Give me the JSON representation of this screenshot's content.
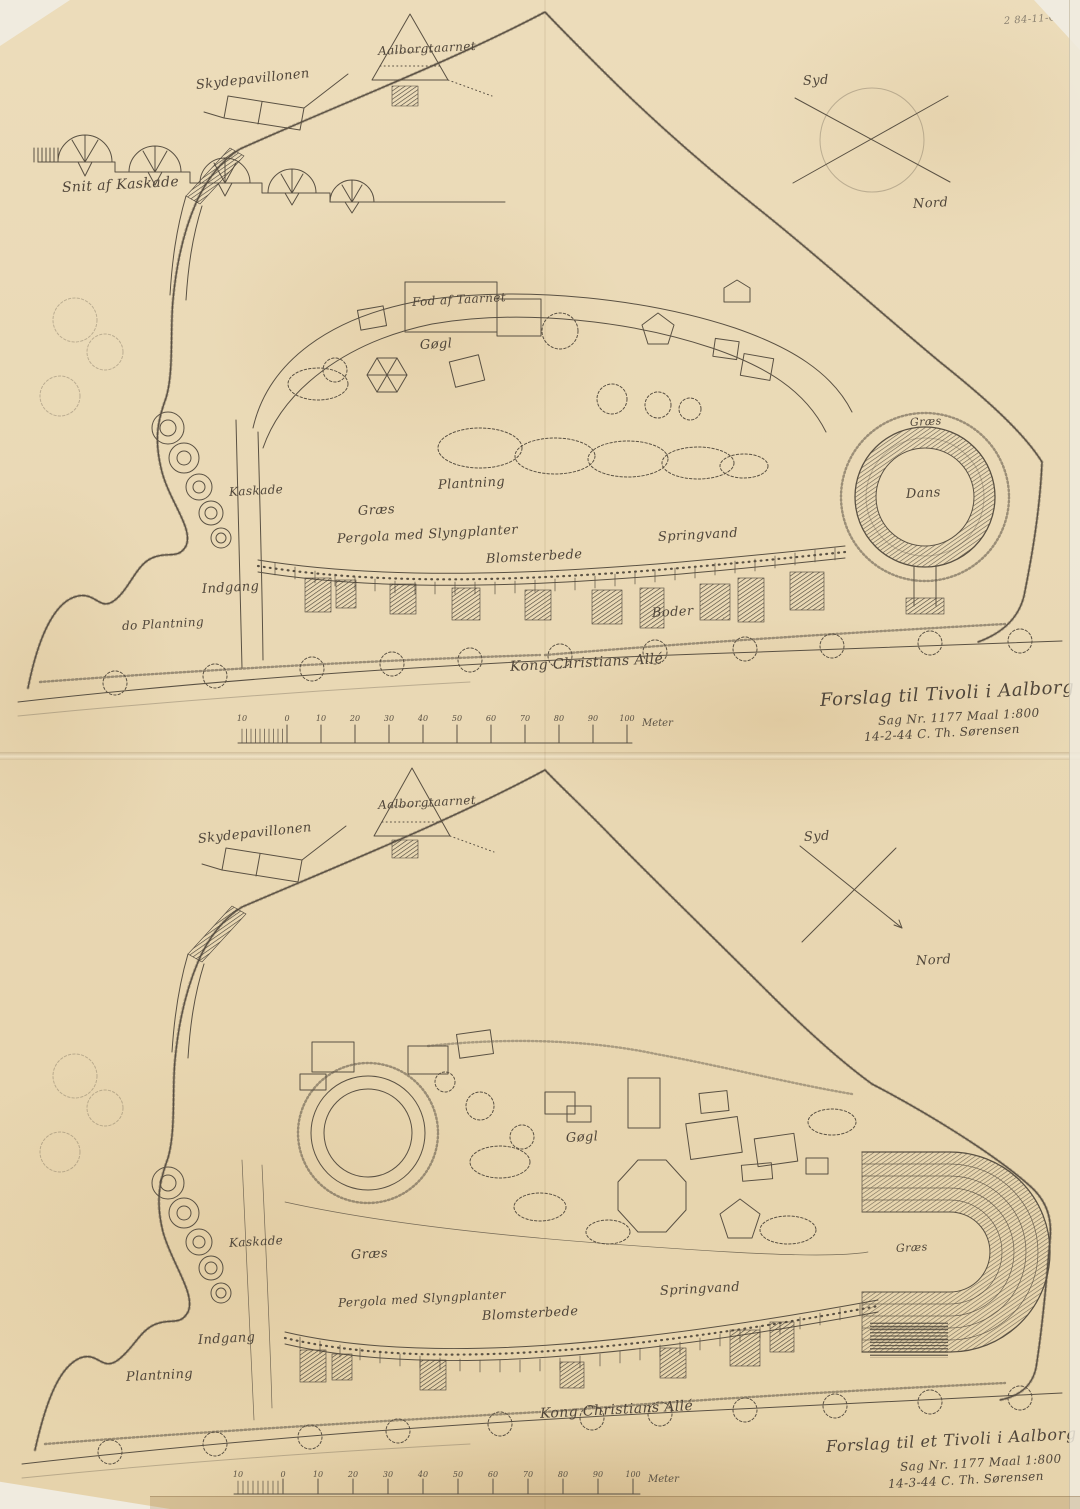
{
  "page": {
    "archive_note": "2 84-11-C"
  },
  "colors": {
    "paper": "#e9d8b4",
    "ink": "#5a5143",
    "ink_dark": "#3c362c",
    "edge": "#f0ebdf"
  },
  "sheets": [
    {
      "name": "upper-variant",
      "title": "Forslag til Tivoli i Aalborg",
      "case_line": "Sag Nr. 1177   Maal 1:800",
      "signature_line": "14-2-44   C. Th. Sørensen",
      "compass": {
        "south": "Syd",
        "north": "Nord"
      },
      "labels": {
        "cascade_section": "Snit af Kaskade",
        "shooting_pavilion": "Skydepavillonen",
        "aalborg_tower": "Aalborgtaarnet",
        "tower_foot": "Fod af Taarnet",
        "amusements": "Gøgl",
        "planting": "Plantning",
        "grass": "Græs",
        "cascade": "Kaskade",
        "pergola": "Pergola med Slyngplanter",
        "flower_beds": "Blomsterbede",
        "fountain": "Springvand",
        "stalls": "Boder",
        "entrance": "Indgang",
        "ditto_planting": "do Plantning",
        "dance_floor": "Dans",
        "grass_ring": "Græs",
        "avenue": "Kong Christians Allé"
      },
      "scalebar": {
        "ticks": [
          "10",
          "0",
          "10",
          "20",
          "30",
          "40",
          "50",
          "60",
          "70",
          "80",
          "90",
          "100"
        ],
        "unit": "Meter"
      }
    },
    {
      "name": "lower-variant",
      "title": "Forslag til et Tivoli i Aalborg",
      "case_line": "Sag Nr. 1177   Maal 1:800",
      "signature_line": "14-3-44   C. Th. Sørensen",
      "compass": {
        "south": "Syd",
        "north": "Nord"
      },
      "labels": {
        "shooting_pavilion": "Skydepavillonen",
        "aalborg_tower": "Aalborgtaarnet",
        "amusements": "Gøgl",
        "planting": "Plantning",
        "grass": "Græs",
        "cascade": "Kaskade",
        "pergola": "Pergola med Slyngplanter",
        "flower_beds": "Blomsterbede",
        "fountain": "Springvand",
        "entrance": "Indgang",
        "grass_arena": "Græs",
        "avenue": "Kong Christians Allé"
      },
      "scalebar": {
        "ticks": [
          "10",
          "0",
          "10",
          "20",
          "30",
          "40",
          "50",
          "60",
          "70",
          "80",
          "90",
          "100"
        ],
        "unit": "Meter"
      }
    }
  ]
}
